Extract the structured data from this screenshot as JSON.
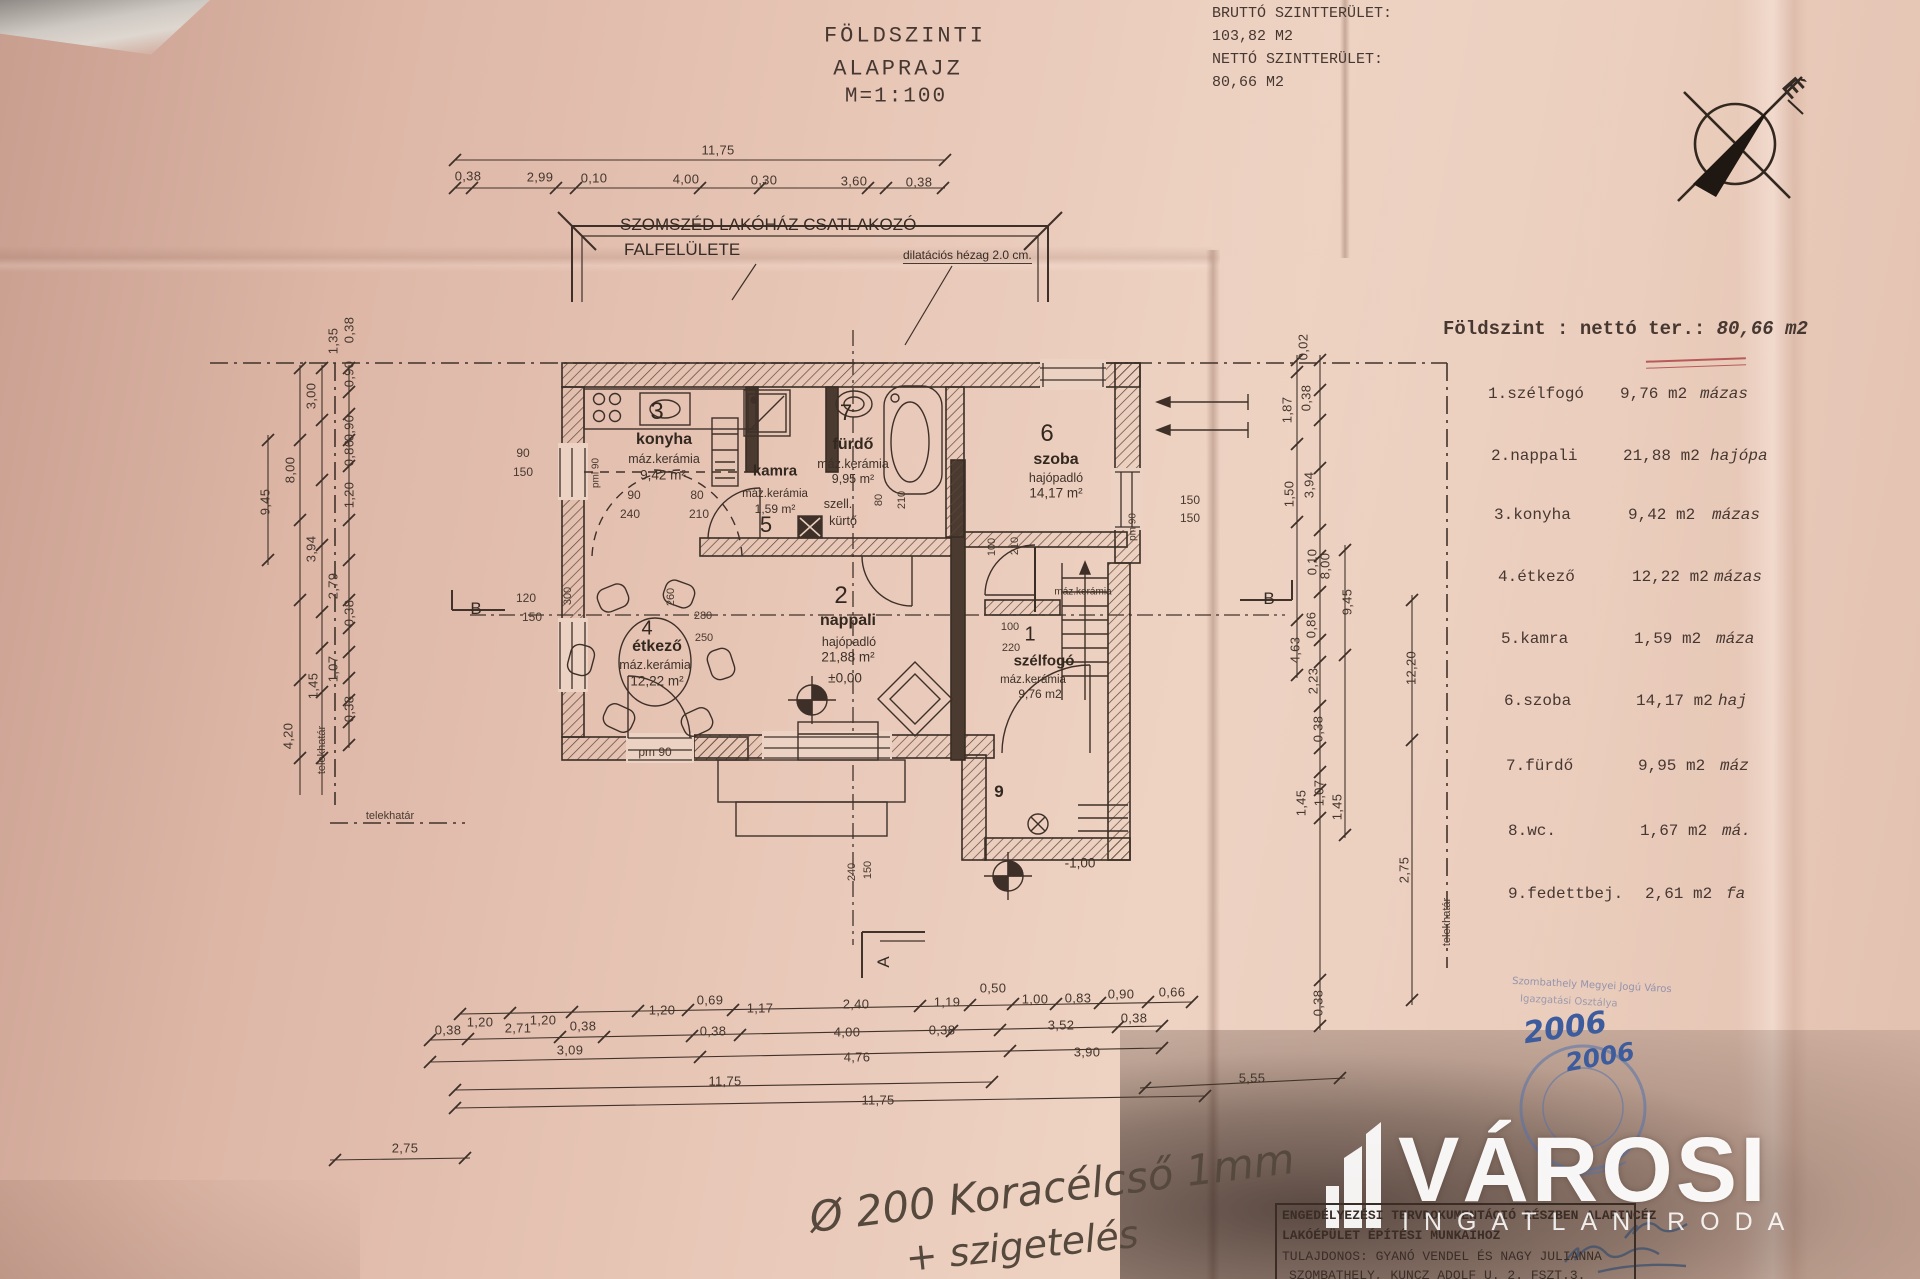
{
  "drawing_header": {
    "line1": "FÖLDSZINTI",
    "line2": "ALAPRAJZ",
    "scale": "M=1:100"
  },
  "area_summary": {
    "gross_label": "BRUTTÓ SZINTTERÜLET:",
    "gross_value": "103,82 M2",
    "net_label": "NETTÓ SZINTTERÜLET:",
    "net_value": "80,66 M2"
  },
  "compass": {
    "north": "É"
  },
  "neighbor_note": {
    "line1": "SZOMSZÉD LAKÓHÁZ CSATLAKOZÓ",
    "line2": "FALFELÜLETE",
    "dilatation": "dilatációs hézag 2.0 cm."
  },
  "room_table": {
    "title_prefix": "Földszint : nettó ter.:",
    "title_value": "80,66 m2",
    "rows": [
      {
        "name": "1.szélfogó",
        "area": "9,76 m2",
        "floor": "mázas"
      },
      {
        "name": "2.nappali",
        "area": "21,88 m2",
        "floor": "hajópa"
      },
      {
        "name": "3.konyha",
        "area": "9,42 m2",
        "floor": "mázas"
      },
      {
        "name": "4.étkező",
        "area": "12,22 m2",
        "floor": "mázas"
      },
      {
        "name": "5.kamra",
        "area": "1,59 m2",
        "floor": "máza"
      },
      {
        "name": "6.szoba",
        "area": "14,17 m2",
        "floor": "haj"
      },
      {
        "name": "7.fürdő",
        "area": "9,95 m2",
        "floor": "máz"
      },
      {
        "name": "8.wc.",
        "area": "1,67 m2",
        "floor": "má."
      },
      {
        "name": "9.fedettbej.",
        "area": "2,61 m2",
        "floor": "fa"
      }
    ]
  },
  "plan": {
    "rooms": {
      "szelfogo": {
        "num": "1",
        "name": "szélfogó",
        "floor": "máz.kerámia",
        "area": "9,76 m2"
      },
      "nappali": {
        "num": "2",
        "name": "nappali",
        "floor": "hajópadló",
        "area": "21,88 m²",
        "level": "±0,00"
      },
      "konyha": {
        "num": "3",
        "name": "konyha",
        "floor": "máz.kerámia",
        "area": "9,42 m²"
      },
      "etkezo": {
        "num": "4",
        "name": "étkező",
        "floor": "máz.kerámia",
        "area": "12,22 m²"
      },
      "kamra": {
        "num": "5",
        "name": "kamra",
        "floor": "máz.kerámia",
        "area": "1,59 m²"
      },
      "szoba": {
        "num": "6",
        "name": "szoba",
        "floor": "hajópadló",
        "area": "14,17 m²"
      },
      "furdo": {
        "num": "7",
        "name": "fürdő",
        "floor": "máz.kerámia",
        "area": "9,95 m²"
      },
      "entry": {
        "num": "9",
        "level": "-1,00"
      },
      "wc_floor": "máz.kerámia"
    },
    "vent": {
      "l1": "szell.",
      "l2": "kürtő"
    },
    "sections": {
      "a": "A",
      "b": "B"
    },
    "boundary": "telekhatár",
    "small_dims": {
      "kw1": "90",
      "kw2": "150",
      "pml": "pml 90",
      "k90": "90",
      "k240": "240",
      "k80": "80",
      "k210": "210",
      "e120": "120",
      "e150": "150",
      "t300": "300",
      "t260": "260",
      "t280": "280",
      "t250": "250",
      "pm90": "pm 90",
      "f80": "80",
      "f210": "210",
      "d100a": "100",
      "d210": "210",
      "d100b": "100",
      "d220": "220",
      "z150a": "150",
      "z150b": "150",
      "zpm": "pm 90",
      "b240": "240",
      "b150": "150"
    }
  },
  "dims": {
    "top_total": "11,75",
    "top": [
      "0,38",
      "2,99",
      "0,10",
      "4,00",
      "0,30",
      "3,60",
      "0,38"
    ],
    "left": [
      "0,38",
      "1,35",
      "0,90",
      "3,00",
      "0,90",
      "0,86",
      "1,20",
      "8,00",
      "9,45",
      "3,94",
      "2,79",
      "0,38",
      "1,07",
      "1,45",
      "0,38",
      "4,20"
    ],
    "right": [
      "0,02",
      "1,87",
      "0,38",
      "3,94",
      "1,50",
      "0,10",
      "8,00",
      "9,45",
      "0,86",
      "4,63",
      "2,23",
      "12,20",
      "0,38",
      "1,45",
      "1,07",
      "1,45",
      "0,38",
      "2,75"
    ],
    "bottom1": [
      "1,20",
      "1,20",
      "1,20",
      "0,69",
      "1,17",
      "2,40",
      "1,19",
      "0,50",
      "1,00",
      "0,83",
      "0,90",
      "0,66"
    ],
    "bottom2": [
      "0,38",
      "2,71",
      "0,38",
      "0,38",
      "4,00",
      "0,38",
      "3,52",
      "0,38"
    ],
    "bottom3": [
      "3,09",
      "4,76",
      "3,90"
    ],
    "bottom4": [
      "11,75",
      "5,55"
    ],
    "bottom5": [
      "11,75"
    ],
    "left_bottom": "2,75"
  },
  "handwriting": {
    "note1": "Ø 200 Koracélcső 1mm",
    "note2": "+ szigetelés",
    "year1": "2006",
    "year2": "2006"
  },
  "title_block": {
    "line1": "ENGEDÉLYEZÉSI  TERVDOKUMENTÁCIÓ  RÉSZBEN  ALAPINCÉZ",
    "line2": "LAKÓÉPÜLET ÉPÍTÉSI MUNKÁIHOZ",
    "line3": "TULAJDONOS: GYANÓ VENDEL ÉS NAGY JULIANNA",
    "line4": "SZOMBATHELY, KUNCZ ADOLF U. 2. FSZT.3."
  },
  "stamp": {
    "l1": "Szombathely Megyei Jogú Város",
    "l2": "Igazgatási Osztálya"
  },
  "logo": {
    "name": "VÁROSI",
    "subtitle": "INGATLANIRODA"
  }
}
